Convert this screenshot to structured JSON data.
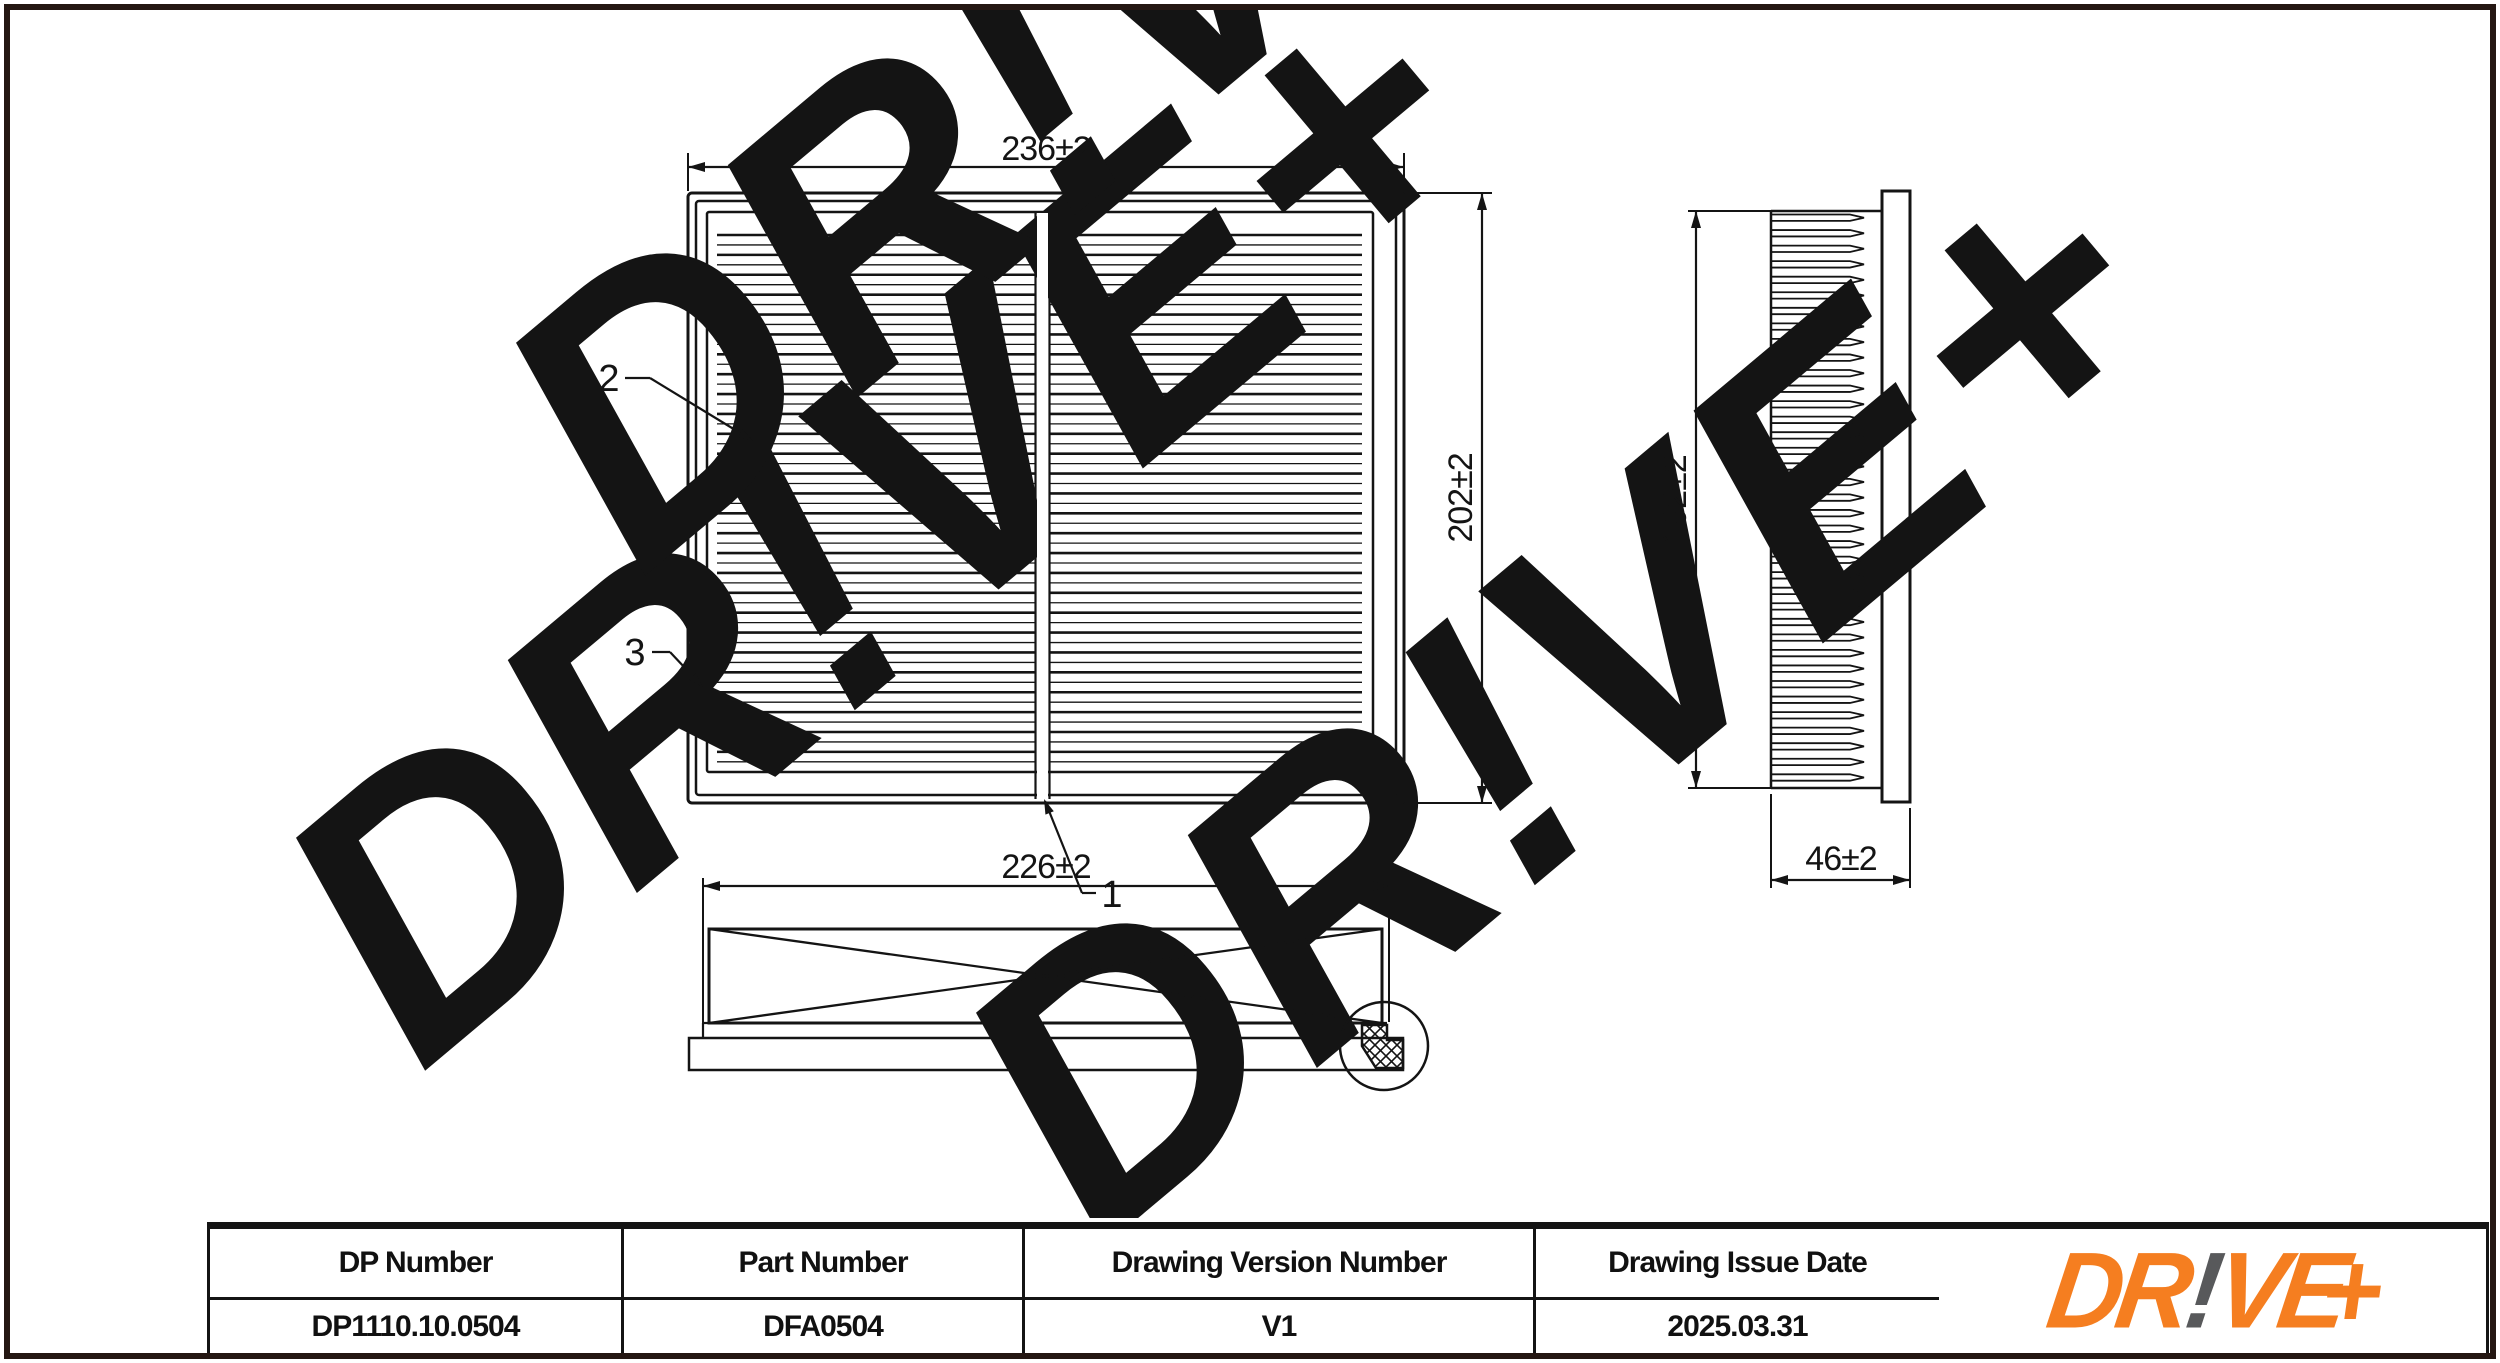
{
  "watermark": {
    "text": "DR!VE+",
    "color": "#EFEFEF"
  },
  "drawing": {
    "front_view": {
      "width_dim": "236±2",
      "height_dim": "202±2"
    },
    "side_view": {
      "height_dim": "192±2",
      "depth_dim": "46±2"
    },
    "bottom_view": {
      "width_dim": "226±2"
    },
    "callouts": {
      "divider": "1",
      "pleat": "2",
      "frame": "3"
    }
  },
  "table": {
    "headers": [
      "DP Number",
      "Part Number",
      "Drawing Version Number",
      "Drawing Issue Date"
    ],
    "values": [
      "DP1110.10.0504",
      "DFA0504",
      "V1",
      "2025.03.31"
    ]
  },
  "logo": {
    "part1": "DR",
    "bang": "!",
    "part2": "VE",
    "plus": "+",
    "orange": "#F57E20",
    "bang_color": "#58595B"
  },
  "colors": {
    "line": "#141414",
    "border": "#241712",
    "watermark": "#EFEFEF"
  }
}
